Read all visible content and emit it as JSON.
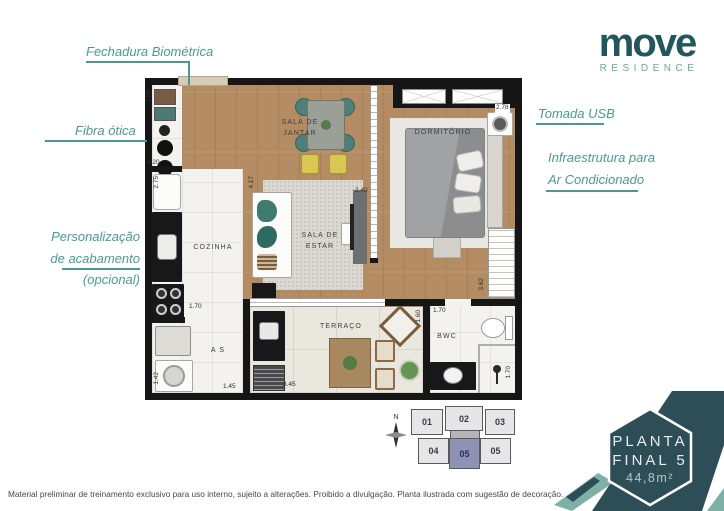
{
  "logo": {
    "name": "move",
    "subtitle": "RESIDENCE"
  },
  "annotations": {
    "fechadura": "Fechadura Biométrica",
    "fibra": "Fibra ótica",
    "personalizacao": [
      "Personalização",
      "de acabamento",
      "(opcional)"
    ],
    "tomada": "Tomada USB",
    "infra": [
      "Infraestrutura para",
      "Ar Condicionado"
    ]
  },
  "rooms": {
    "dining": [
      "SALA DE",
      "JANTAR"
    ],
    "bedroom": "DORMITÓRIO",
    "kitchen": "COZINHA",
    "living": [
      "SALA DE",
      "ESTAR"
    ],
    "terrace": "TERRAÇO",
    "laundry": "A S",
    "bathroom": "BWC"
  },
  "measurements": {
    "entry_h": "1.58",
    "entry_w": "4.20",
    "kitchen_h": "2.75",
    "kitchen_door": "1.70",
    "laundry_w": "1.45",
    "laundry_h": "1.42",
    "living_h": "4.17",
    "living_w": "2.40",
    "bedroom_w": "2.78",
    "closet_h": "3.62",
    "terrace_w": "3.45",
    "terrace_h": "1.60",
    "bathroom_w": "1.70",
    "bathroom_h": "1.70"
  },
  "keyplan": {
    "north": "N",
    "units": [
      "01",
      "02",
      "03",
      "04",
      "05",
      "06"
    ],
    "highlighted_unit": "05"
  },
  "badge": {
    "line1": "PLANTA",
    "line2": "FINAL 5",
    "area": "44,8m²"
  },
  "disclaimer": "Material preliminar de treinamento exclusivo para uso interno, sujeito a alterações. Proibido a divulgação. Planta ilustrada com sugestão de decoração.",
  "colors": {
    "brand_dark": "#20565c",
    "annotation_teal": "#4a9a92",
    "badge_dark": "#2d4e57",
    "badge_light": "#7fb0a6",
    "unit_highlight": "#8e93b5"
  }
}
